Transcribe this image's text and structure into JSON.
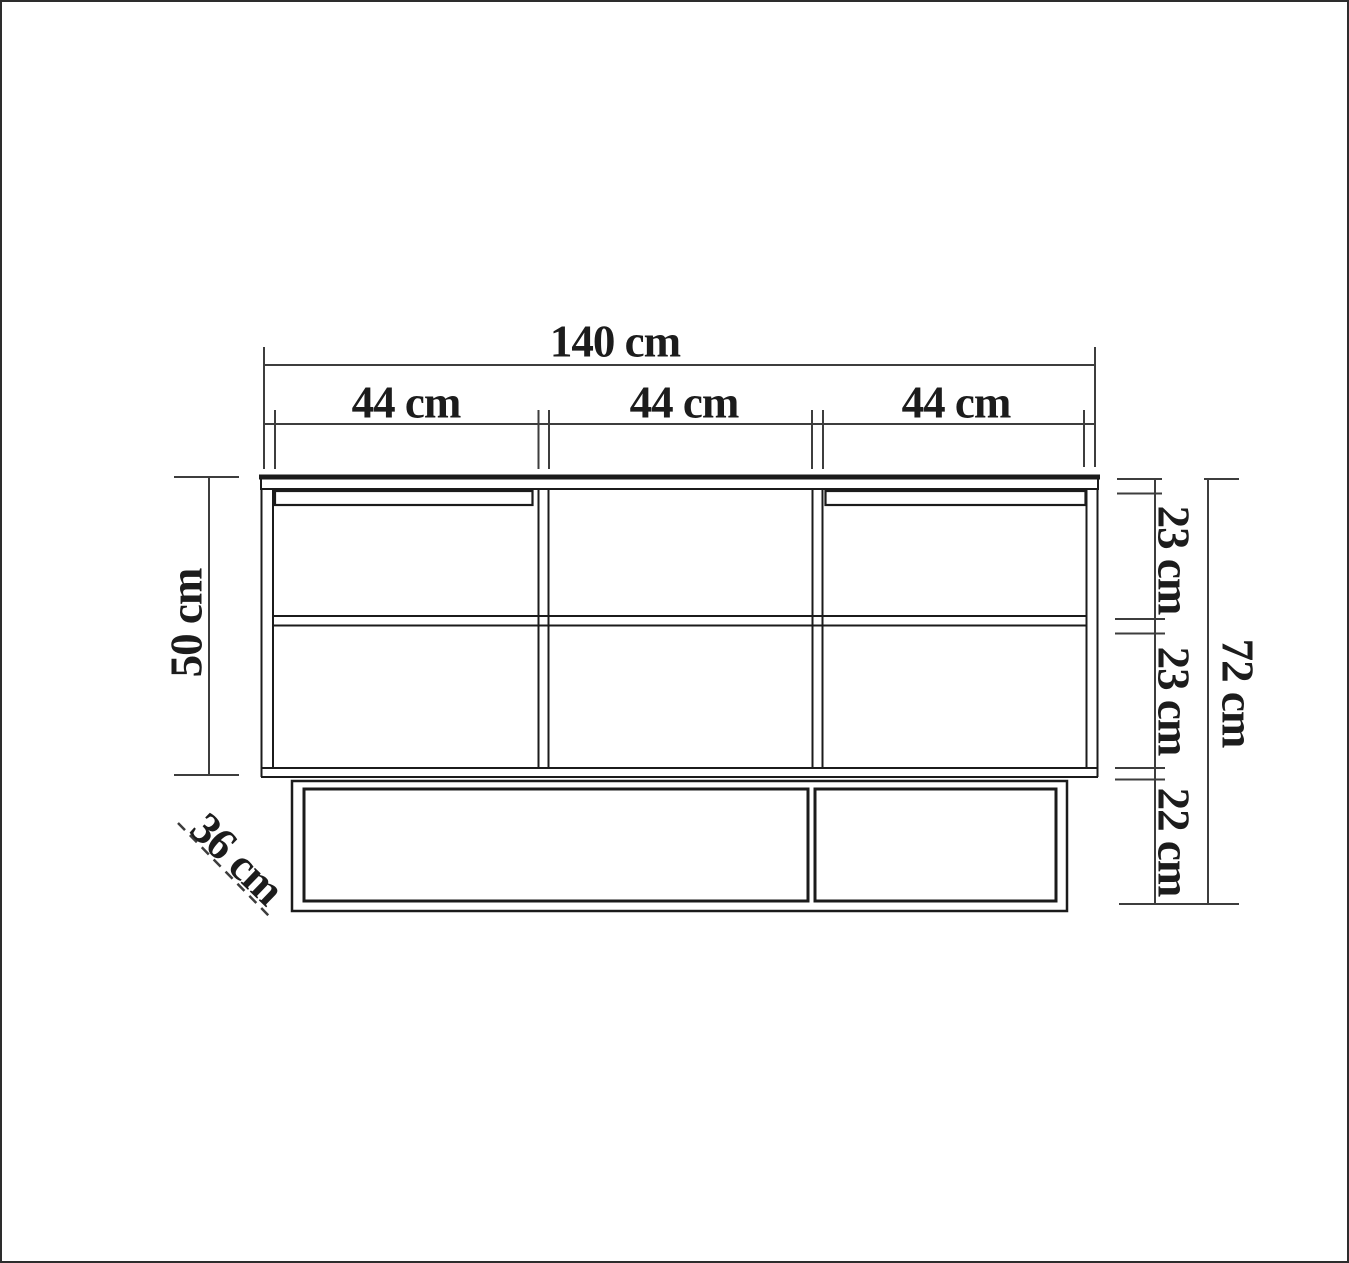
{
  "page": {
    "background": "#ffffff",
    "frame_color": "#2d2d2d",
    "line_color": "#1b1b1b",
    "dimension_color": "#3d3d3d"
  },
  "labels": {
    "overall_width": "140 cm",
    "section_widths": [
      "44 cm",
      "44 cm",
      "44 cm"
    ],
    "cabinet_height": "50 cm",
    "upper_compartment_height": "23 cm",
    "lower_compartment_height": "23 cm",
    "base_height": "22 cm",
    "total_height": "72 cm",
    "depth": "36 cm"
  }
}
